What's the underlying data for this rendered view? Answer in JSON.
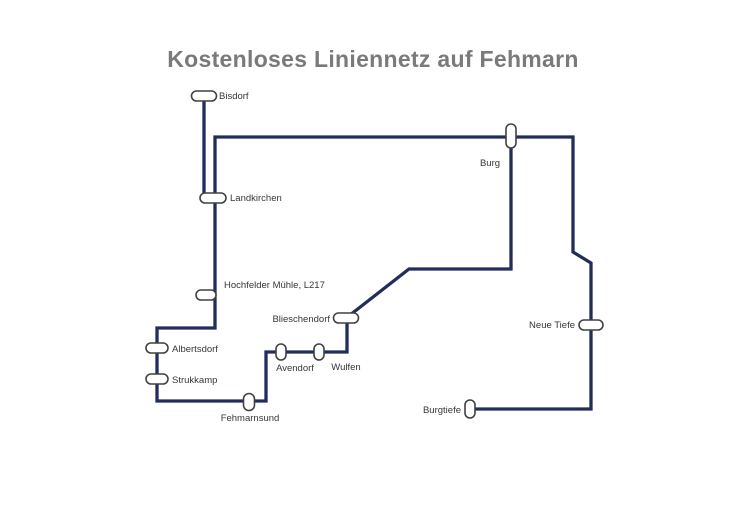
{
  "title": "Kostenloses Liniennetz auf Fehmarn",
  "colors": {
    "background": "#ffffff",
    "route_line": "#232d5c",
    "stop_fill": "#ffffff",
    "stop_border": "#414141",
    "title_text": "#7a7a7a",
    "label_text": "#373737"
  },
  "network": {
    "line_width": 3.3,
    "stop_border_width": 1.6,
    "segments": [
      {
        "id": "bisdorf-spur",
        "points": "204,96 204,198"
      },
      {
        "id": "landkirchen-to-burg",
        "points": "215,198 215,137 511,137"
      },
      {
        "id": "south-west-loop",
        "points": "215,198 215,328 157,328 157,401 266,401 266,352 347,352 347,318"
      },
      {
        "id": "blieschendorf-to-burg",
        "points": "350,315 409,269 511,269 511,137"
      },
      {
        "id": "burg-east-branch",
        "points": "511,137 573,137 573,252 591,263 591,409 469,409"
      }
    ],
    "stations": [
      {
        "label": "Bisdorf",
        "x": 204,
        "y": 96,
        "w": 25,
        "h": 10,
        "label_x": 219,
        "label_y": 99,
        "anchor": "start"
      },
      {
        "label": "Landkirchen",
        "x": 213,
        "y": 198,
        "w": 26,
        "h": 10,
        "label_x": 230,
        "label_y": 201,
        "anchor": "start"
      },
      {
        "label": "Burg",
        "x": 511,
        "y": 136,
        "w": 10,
        "h": 24,
        "label_x": 490,
        "label_y": 166,
        "anchor": "middle"
      },
      {
        "label": "Hochfelder Mühle, L217",
        "x": 206,
        "y": 295,
        "w": 20,
        "h": 10,
        "label_x": 224,
        "label_y": 288,
        "anchor": "start"
      },
      {
        "label": "Albertsdorf",
        "x": 157,
        "y": 348,
        "w": 22,
        "h": 10,
        "label_x": 172,
        "label_y": 352,
        "anchor": "start"
      },
      {
        "label": "Strukkamp",
        "x": 157,
        "y": 379,
        "w": 22,
        "h": 10,
        "label_x": 172,
        "label_y": 383,
        "anchor": "start"
      },
      {
        "label": "Fehmarnsund",
        "x": 249,
        "y": 402,
        "w": 11,
        "h": 17,
        "label_x": 250,
        "label_y": 421,
        "anchor": "middle"
      },
      {
        "label": "Avendorf",
        "x": 281,
        "y": 352,
        "w": 10,
        "h": 16,
        "label_x": 295,
        "label_y": 371,
        "anchor": "middle"
      },
      {
        "label": "Wulfen",
        "x": 319,
        "y": 352,
        "w": 10,
        "h": 16,
        "label_x": 346,
        "label_y": 370,
        "anchor": "middle"
      },
      {
        "label": "Blieschendorf",
        "x": 346,
        "y": 318,
        "w": 25,
        "h": 10,
        "label_x": 330,
        "label_y": 322,
        "anchor": "end"
      },
      {
        "label": "Neue Tiefe",
        "x": 591,
        "y": 325,
        "w": 24,
        "h": 10,
        "label_x": 575,
        "label_y": 328,
        "anchor": "end"
      },
      {
        "label": "Burgtiefe",
        "x": 470,
        "y": 409,
        "w": 10,
        "h": 18,
        "label_x": 461,
        "label_y": 413,
        "anchor": "end"
      }
    ]
  }
}
